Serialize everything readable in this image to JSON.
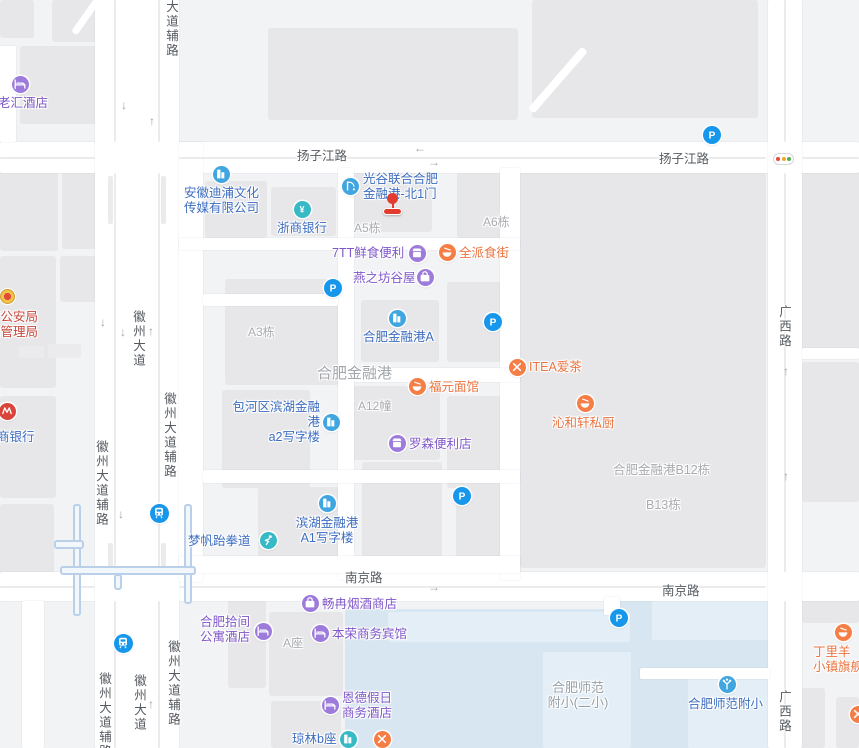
{
  "map_title": "合肥金融港地图",
  "colors": {
    "poi_blue": "#3d6dc0",
    "poi_purple": "#7f57c8",
    "poi_orange": "#ea7440",
    "poi_red": "#c8473b",
    "gray_label": "#a9abaf",
    "area_label": "#a2a6ac",
    "school_label": "#97a0a8",
    "road_label": "#565b61",
    "ic_blue": "#41a6e0",
    "ic_teal": "#38bac6",
    "ic_purple": "#9d7bdb",
    "ic_orange": "#f57e47",
    "ic_pblue": "#1697ec",
    "ic_red": "#d9453a",
    "marker_red": "#e23c30"
  },
  "buildings": [
    [
      0,
      0,
      34,
      38
    ],
    [
      52,
      0,
      46,
      42
    ],
    [
      20,
      46,
      80,
      78
    ],
    [
      268,
      28,
      250,
      92
    ],
    [
      532,
      0,
      226,
      118
    ],
    [
      0,
      163,
      58,
      88
    ],
    [
      62,
      167,
      36,
      82
    ],
    [
      0,
      256,
      56,
      132
    ],
    [
      60,
      256,
      40,
      46
    ],
    [
      0,
      396,
      56,
      102
    ],
    [
      0,
      504,
      54,
      72
    ],
    [
      205,
      181,
      62,
      57
    ],
    [
      271,
      187,
      65,
      49
    ],
    [
      347,
      168,
      85,
      64
    ],
    [
      457,
      172,
      62,
      66
    ],
    [
      225,
      279,
      114,
      106
    ],
    [
      361,
      300,
      78,
      62
    ],
    [
      447,
      282,
      72,
      80
    ],
    [
      352,
      386,
      88,
      74
    ],
    [
      222,
      390,
      88,
      98
    ],
    [
      447,
      396,
      72,
      92
    ],
    [
      258,
      487,
      88,
      70
    ],
    [
      362,
      462,
      80,
      100
    ],
    [
      456,
      462,
      52,
      98
    ],
    [
      520,
      172,
      246,
      396
    ],
    [
      802,
      166,
      57,
      184
    ],
    [
      802,
      362,
      57,
      140
    ],
    [
      228,
      598,
      38,
      90
    ],
    [
      269,
      612,
      74,
      84
    ],
    [
      271,
      701,
      70,
      47
    ],
    [
      802,
      597,
      57,
      26
    ],
    [
      793,
      688,
      32,
      60
    ],
    [
      836,
      697,
      23,
      51
    ]
  ],
  "waters": [
    [
      345,
      609,
      290,
      139
    ],
    [
      620,
      597,
      150,
      151
    ]
  ],
  "waters_light": [
    [
      388,
      612,
      242,
      30
    ],
    [
      543,
      652,
      88,
      96
    ],
    [
      652,
      598,
      118,
      42
    ],
    [
      688,
      676,
      82,
      72
    ]
  ],
  "roads": [
    [
      0,
      142,
      859,
      31
    ],
    [
      0,
      572,
      859,
      29
    ],
    [
      95,
      0,
      84,
      748
    ],
    [
      768,
      0,
      34,
      748
    ],
    [
      179,
      142,
      24,
      440
    ],
    [
      338,
      168,
      16,
      412
    ],
    [
      500,
      168,
      20,
      412
    ],
    [
      179,
      238,
      341,
      12
    ],
    [
      203,
      294,
      135,
      12
    ],
    [
      354,
      368,
      166,
      14
    ],
    [
      203,
      470,
      317,
      13
    ],
    [
      179,
      556,
      341,
      17
    ],
    [
      802,
      348,
      57,
      11
    ],
    [
      0,
      46,
      16,
      96
    ],
    [
      22,
      601,
      22,
      147
    ],
    [
      640,
      668,
      130,
      11
    ],
    [
      604,
      597,
      16,
      18
    ]
  ],
  "medians": [
    [
      114,
      0,
      2,
      142
    ],
    [
      114,
      173,
      2,
      399
    ],
    [
      114,
      601,
      2,
      147
    ],
    [
      158,
      0,
      2,
      142
    ],
    [
      158,
      173,
      2,
      399
    ],
    [
      158,
      601,
      2,
      147
    ],
    [
      784,
      0,
      2,
      142
    ],
    [
      784,
      173,
      2,
      399
    ],
    [
      784,
      601,
      2,
      147
    ],
    [
      0,
      157,
      95,
      2
    ],
    [
      179,
      157,
      587,
      2
    ],
    [
      802,
      157,
      57,
      2
    ],
    [
      0,
      586,
      95,
      2
    ],
    [
      179,
      586,
      587,
      2
    ],
    [
      108,
      176,
      5,
      48
    ],
    [
      161,
      176,
      5,
      48
    ],
    [
      18,
      346,
      26,
      12
    ],
    [
      48,
      344,
      33,
      14
    ],
    [
      108,
      543,
      5,
      26
    ],
    [
      161,
      543,
      5,
      26
    ]
  ],
  "metro_lines": [
    [
      73,
      504,
      8,
      112
    ],
    [
      184,
      504,
      8,
      100
    ],
    [
      60,
      566,
      136,
      9
    ],
    [
      54,
      540,
      30,
      9
    ],
    [
      114,
      574,
      8,
      16
    ]
  ],
  "diagonals": [
    {
      "x": 531,
      "y": 107,
      "len": 82,
      "h": 8,
      "deg": -49
    },
    {
      "x": 74,
      "y": 30,
      "len": 46,
      "h": 7,
      "deg": -55
    }
  ],
  "arrows": [
    {
      "d": "↓",
      "x": 121,
      "y": 99
    },
    {
      "d": "↑",
      "x": 149,
      "y": 115
    },
    {
      "d": "←",
      "x": 414,
      "y": 142
    },
    {
      "d": "→",
      "x": 428,
      "y": 156
    },
    {
      "d": "↓",
      "x": 100,
      "y": 316
    },
    {
      "d": "↓",
      "x": 120,
      "y": 326
    },
    {
      "d": "↑",
      "x": 148,
      "y": 325
    },
    {
      "d": "↓",
      "x": 118,
      "y": 508
    },
    {
      "d": "↑",
      "x": 148,
      "y": 698
    },
    {
      "d": "→",
      "x": 428,
      "y": 581
    },
    {
      "d": "↑",
      "x": 783,
      "y": 365
    },
    {
      "d": "↑",
      "x": 783,
      "y": 470
    }
  ],
  "road_labels": [
    {
      "text": "扬子江路",
      "x": 297,
      "y": 149,
      "vertical": false
    },
    {
      "text": "扬子江路",
      "x": 659,
      "y": 152,
      "vertical": false
    },
    {
      "text": "南京路",
      "x": 345,
      "y": 571,
      "vertical": false
    },
    {
      "text": "南京路",
      "x": 662,
      "y": 584,
      "vertical": false
    },
    {
      "text": "大道辅路",
      "x": 164,
      "y": 0,
      "vertical": true
    },
    {
      "text": "徽州大道",
      "x": 131,
      "y": 310,
      "vertical": true
    },
    {
      "text": "徽州大道辅路",
      "x": 162,
      "y": 392,
      "vertical": true
    },
    {
      "text": "徽州大道辅路",
      "x": 94,
      "y": 440,
      "vertical": true
    },
    {
      "text": "徽州大道辅路",
      "x": 166,
      "y": 640,
      "vertical": true
    },
    {
      "text": "徽州大道",
      "x": 132,
      "y": 674,
      "vertical": true
    },
    {
      "text": "徽州大道辅路",
      "x": 97,
      "y": 672,
      "vertical": true
    },
    {
      "text": "广西路",
      "x": 777,
      "y": 305,
      "vertical": true
    },
    {
      "text": "广西路",
      "x": 777,
      "y": 690,
      "vertical": true
    }
  ],
  "area_labels": [
    {
      "text": "A5栋",
      "x": 354,
      "y": 221,
      "size": 12,
      "color": "gray_label"
    },
    {
      "text": "A6栋",
      "x": 483,
      "y": 215,
      "size": 12,
      "color": "gray_label"
    },
    {
      "text": "A3栋",
      "x": 248,
      "y": 325,
      "size": 12,
      "color": "gray_label"
    },
    {
      "text": "A12幢",
      "x": 358,
      "y": 399,
      "size": 12,
      "color": "gray_label"
    },
    {
      "text": "A座",
      "x": 283,
      "y": 636,
      "size": 12,
      "color": "gray_label"
    },
    {
      "text": "合肥金融港",
      "x": 317,
      "y": 366,
      "size": 15,
      "color": "area_label"
    },
    {
      "text": "合肥金融港B12栋",
      "x": 613,
      "y": 463,
      "size": 12.5,
      "color": "gray_label"
    },
    {
      "text": "B13栋",
      "x": 646,
      "y": 498,
      "size": 12.5,
      "color": "gray_label"
    },
    {
      "text": "合肥师范\n附小(二小)",
      "x": 540,
      "y": 680,
      "size": 13,
      "color": "school_label",
      "center": 76
    }
  ],
  "pois": [
    {
      "id": "laohui-hotel",
      "lines": [
        "老汇酒店"
      ],
      "lx": -2,
      "ly": 96,
      "cat": "poi_purple",
      "icon": "bed",
      "bg": "ic_purple",
      "ix": 20,
      "iy": 84
    },
    {
      "id": "anhui-dipu-media",
      "lines": [
        "安徽迪浦文化",
        "传媒有限公司"
      ],
      "lx": 184,
      "ly": 186,
      "cat": "poi_blue",
      "icon": "building",
      "bg": "ic_blue",
      "ix": 221,
      "iy": 174
    },
    {
      "id": "guanggu-north-gate-1",
      "lines": [
        "光谷联合合肥",
        "金融港-北1门"
      ],
      "lx": 363,
      "ly": 172,
      "cat": "poi_blue",
      "icon": "gate",
      "bg": "ic_blue",
      "ix": 350,
      "iy": 186
    },
    {
      "id": "zheshang-bank",
      "lines": [
        "浙商银行"
      ],
      "lx": 277,
      "ly": 221,
      "cat": "poi_blue",
      "icon": "yuan",
      "bg": "ic_teal",
      "ix": 302,
      "iy": 209
    },
    {
      "id": "7tt-convenience",
      "lines": [
        "7TT鲜食便利"
      ],
      "lx": 332,
      "ly": 246,
      "cat": "poi_purple",
      "icon": "shop",
      "bg": "ic_purple",
      "ix": 417,
      "iy": 253
    },
    {
      "id": "quanpai-food-street",
      "lines": [
        "全派食街"
      ],
      "lx": 459,
      "ly": 246,
      "cat": "poi_orange",
      "icon": "bowl",
      "bg": "ic_orange",
      "ix": 447,
      "iy": 252
    },
    {
      "id": "yanzhifang-guwu",
      "lines": [
        "燕之坊谷屋"
      ],
      "lx": 353,
      "ly": 271,
      "cat": "poi_purple",
      "icon": "bag",
      "bg": "ic_purple",
      "ix": 425,
      "iy": 277
    },
    {
      "id": "hefei-financial-port-a",
      "lines": [
        "合肥金融港A"
      ],
      "lx": 363,
      "ly": 330,
      "cat": "poi_blue",
      "icon": "building",
      "bg": "ic_blue",
      "ix": 397,
      "iy": 318
    },
    {
      "id": "itea-tea",
      "lines": [
        "ITEA爱茶"
      ],
      "lx": 529,
      "ly": 360,
      "cat": "poi_orange",
      "icon": "forkknife",
      "bg": "ic_orange",
      "ix": 517,
      "iy": 367
    },
    {
      "id": "fuyuan-noodles",
      "lines": [
        "福元面馆"
      ],
      "lx": 429,
      "ly": 380,
      "cat": "poi_orange",
      "icon": "bowl",
      "bg": "ic_orange",
      "ix": 417,
      "iy": 386
    },
    {
      "id": "qinhexuan-kitchen",
      "lines": [
        "沁和轩私厨"
      ],
      "lx": 552,
      "ly": 416,
      "cat": "poi_orange",
      "icon": "bowl",
      "bg": "ic_orange",
      "ix": 585,
      "iy": 403
    },
    {
      "id": "baohe-a2-tower",
      "lines": [
        "包河区滨湖金融港",
        "a2写字楼"
      ],
      "lx": 222,
      "ly": 400,
      "cat": "poi_blue",
      "icon": "building",
      "bg": "ic_blue",
      "ix": 331,
      "iy": 422,
      "align": "right",
      "w": 98
    },
    {
      "id": "lawson",
      "lines": [
        "罗森便利店"
      ],
      "lx": 409,
      "ly": 437,
      "cat": "poi_purple",
      "icon": "shop",
      "bg": "ic_purple",
      "ix": 397,
      "iy": 443
    },
    {
      "id": "binhu-a1-tower",
      "lines": [
        "滨湖金融港",
        "A1写字楼"
      ],
      "lx": 292,
      "ly": 516,
      "cat": "poi_blue",
      "icon": "building",
      "bg": "ic_blue",
      "ix": 327,
      "iy": 503,
      "align": "center",
      "w": 70
    },
    {
      "id": "mengfan-taekwondo",
      "lines": [
        "梦帆跆拳道"
      ],
      "lx": 188,
      "ly": 534,
      "cat": "poi_blue",
      "icon": "fist",
      "bg": "ic_teal",
      "ix": 268,
      "iy": 540
    },
    {
      "id": "changran-tobacco",
      "lines": [
        "畅冉烟酒商店"
      ],
      "lx": 322,
      "ly": 597,
      "cat": "poi_purple",
      "icon": "bag",
      "bg": "ic_purple",
      "ix": 310,
      "iy": 603
    },
    {
      "id": "hefei-shijian-apartment",
      "lines": [
        "合肥拾间",
        "公寓酒店"
      ],
      "lx": 200,
      "ly": 615,
      "cat": "poi_purple",
      "icon": "bed",
      "bg": "ic_purple",
      "ix": 263,
      "iy": 631
    },
    {
      "id": "benrong-hotel",
      "lines": [
        "本荣商务宾馆"
      ],
      "lx": 332,
      "ly": 627,
      "cat": "poi_purple",
      "icon": "bed",
      "bg": "ic_purple",
      "ix": 320,
      "iy": 633
    },
    {
      "id": "ende-holiday-hotel",
      "lines": [
        "恩德假日",
        "商务酒店"
      ],
      "lx": 342,
      "ly": 691,
      "cat": "poi_purple",
      "icon": "bed",
      "bg": "ic_purple",
      "ix": 330,
      "iy": 705
    },
    {
      "id": "qionglin-b",
      "lines": [
        "琼林b座"
      ],
      "lx": 292,
      "ly": 732,
      "cat": "poi_blue",
      "icon": "building",
      "bg": "ic_teal",
      "ix": 348,
      "iy": 739
    },
    {
      "id": "restaurant-unnamed",
      "lines": [],
      "lx": 0,
      "ly": 0,
      "cat": "poi_orange",
      "icon": "forkknife",
      "bg": "ic_orange",
      "ix": 382,
      "iy": 739
    },
    {
      "id": "hefei-normal-primary",
      "lines": [
        "合肥师范附小"
      ],
      "lx": 688,
      "ly": 697,
      "cat": "poi_blue",
      "icon": "school",
      "bg": "ic_blue",
      "ix": 727,
      "iy": 684
    },
    {
      "id": "dingliyang-flagship",
      "lines": [
        "丁里羊",
        "小镇旗舰店"
      ],
      "lx": 813,
      "ly": 645,
      "cat": "poi_orange",
      "icon": "bowl",
      "bg": "ic_orange",
      "ix": 843,
      "iy": 632
    },
    {
      "id": "restaurant-edge",
      "lines": [],
      "lx": 0,
      "ly": 0,
      "cat": "poi_orange",
      "icon": "forkknife",
      "bg": "ic_orange",
      "ix": 858,
      "iy": 714
    },
    {
      "id": "public-security-bureau",
      "lines": [
        "市公安局",
        "通管理局"
      ],
      "lx": -12,
      "ly": 310,
      "cat": "poi_red",
      "icon": "policebadge",
      "bg": "ic_red",
      "ix": 7,
      "iy": 296
    },
    {
      "id": "huishang-bank",
      "lines": [
        "商银行"
      ],
      "lx": -3,
      "ly": 430,
      "cat": "poi_blue",
      "icon": "mlogo",
      "bg": "ic_red",
      "ix": 7,
      "iy": 411
    }
  ],
  "parkings": [
    [
      333,
      288
    ],
    [
      493,
      322
    ],
    [
      712,
      135
    ],
    [
      462,
      496
    ],
    [
      619,
      618
    ]
  ],
  "metros": [
    [
      159,
      513
    ],
    [
      123,
      643
    ]
  ],
  "traffic_light": {
    "x": 773,
    "y": 153,
    "w": 21,
    "h": 12,
    "dots": [
      "#e5493d",
      "#f5a623",
      "#4caf50"
    ]
  },
  "marker": {
    "x": 383,
    "y": 193,
    "label": "北1门位置标记"
  },
  "school_area_label": {
    "line1": "合肥师范",
    "line2": "附小(二小)"
  }
}
